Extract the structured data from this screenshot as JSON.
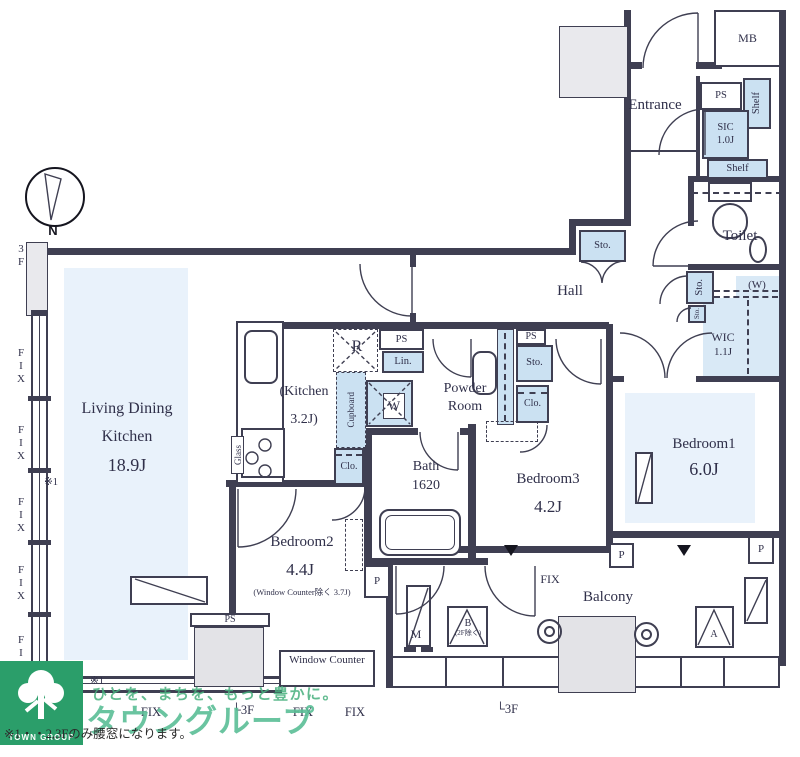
{
  "plan": {
    "compass_n": "N",
    "rooms": {
      "ldk1": "Living Dining",
      "ldk2": "Kitchen",
      "ldk_size": "18.9J",
      "kitchen": "(Kitchen",
      "kitchen_size": "3.2J)",
      "powder1": "Powder",
      "powder2": "Room",
      "bath": "Bath",
      "bath_size": "1620",
      "bedroom2": "Bedroom2",
      "bedroom2_size": "4.4J",
      "bedroom2_note": "(Window Counter除く 3.7J)",
      "bedroom3": "Bedroom3",
      "bedroom3_size": "4.2J",
      "bedroom1": "Bedroom1",
      "bedroom1_size": "6.0J",
      "wic": "WIC",
      "wic_size": "1.1J",
      "sic": "SIC",
      "sic_size": "1.0J",
      "toilet": "Toilet",
      "hall": "Hall",
      "entrance": "Entrance",
      "balcony": "Balcony",
      "mb": "MB"
    },
    "storage": {
      "ps": "PS",
      "sto": "Sto.",
      "clo": "Clo.",
      "lin": "Lin.",
      "shelf": "Shelf",
      "cupboard": "Cupboard",
      "wic_pipe": "(W)"
    },
    "fixtures": {
      "fridge": "R",
      "washer": "W",
      "glass": "Glass",
      "mirror": "M",
      "hatch_a": "A",
      "hatch_b": "B",
      "hatch_b_note": "(2F除く)",
      "window_counter": "Window Counter"
    },
    "marks": {
      "fix": "FIX",
      "floor": "3F",
      "floor_corner": "└3F",
      "note1": "※1",
      "p": "P"
    }
  },
  "colors": {
    "wall": "#3f3f52",
    "room_fill": "#e9f2fb",
    "closet_fill": "#cbe1f2",
    "brand_green": "#2b9e6a"
  },
  "footer": {
    "note": "※1・・2,3Fのみ腰窓になります。",
    "tagline": "ひとを、まちを、もっと豊かに。",
    "brand": "タウングループ",
    "logo": "TOWN GROUP"
  }
}
